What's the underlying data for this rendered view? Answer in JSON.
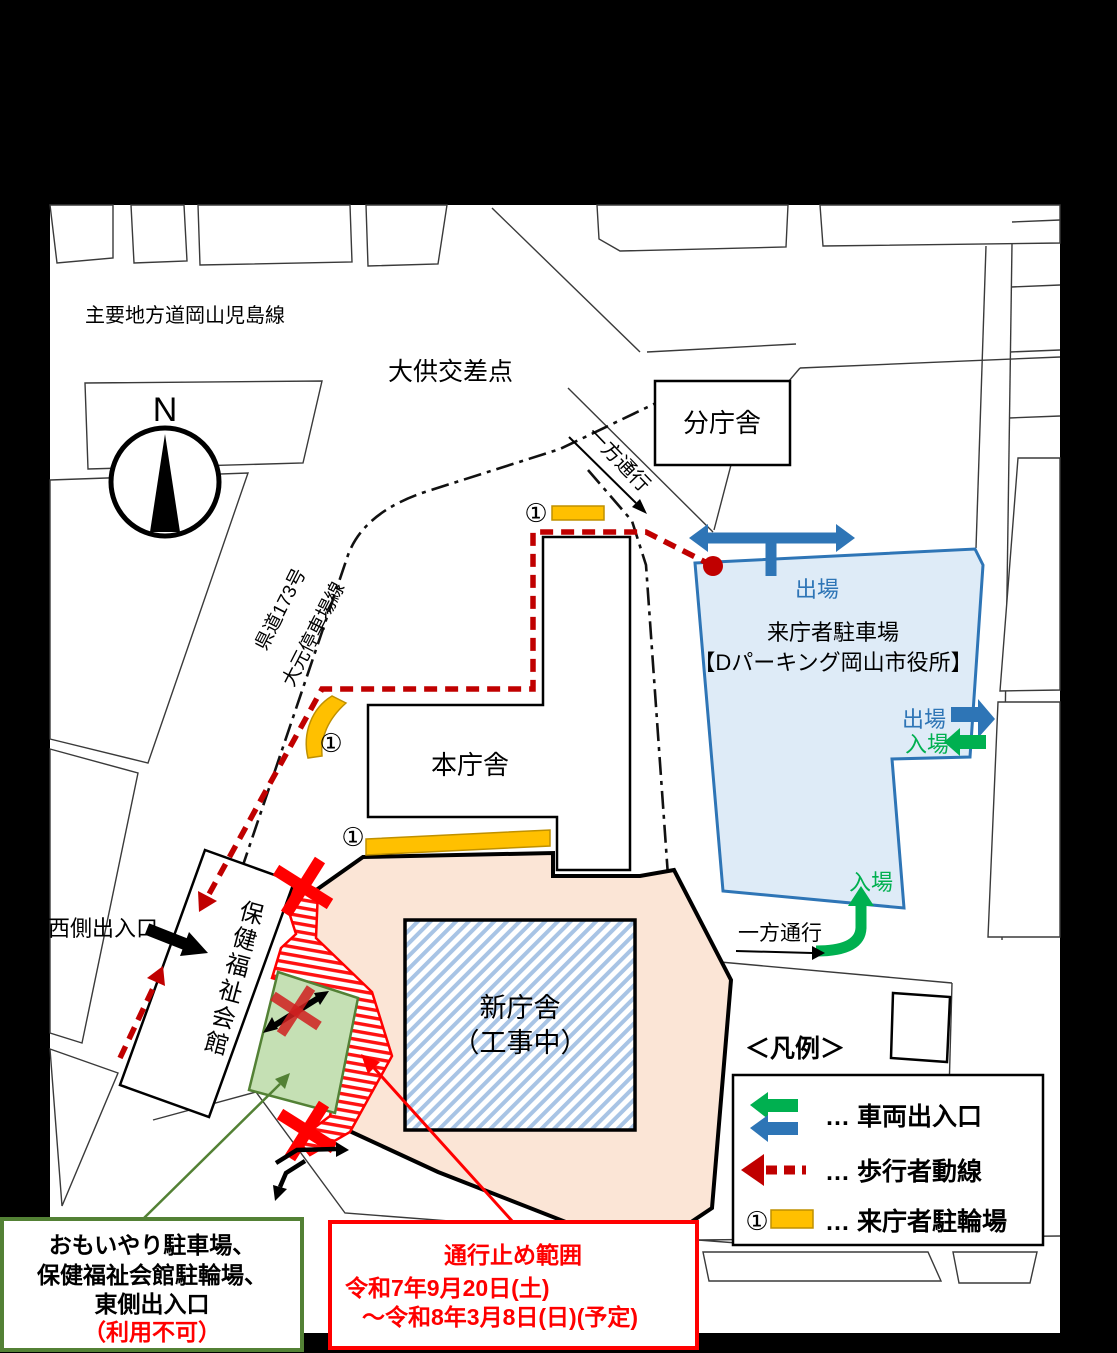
{
  "colors": {
    "background": "#000000",
    "map_bg": "#ffffff",
    "pedestrian_red": "#C00000",
    "bright_red": "#FF0000",
    "blue_arrow": "#2E75B6",
    "green_arrow": "#00B050",
    "green_border": "#538135",
    "parking_fill": "#DEEBF7",
    "construction_fill": "#FBE5D6",
    "hatch_blue": "#A8C4E5",
    "bike_yellow": "#FFC000",
    "bike_yellow_border": "#BF9000",
    "green_area_fill": "#C5E0B4"
  },
  "map": {
    "road_main_label": "主要地方道岡山児島線",
    "intersection_label": "大供交差点",
    "compass_label": "N",
    "pref_road_line1": "県道173号",
    "pref_road_line2": "大元停車場線",
    "one_way_top": "一方通行",
    "one_way_bottom": "一方通行",
    "branch_building": "分庁舎",
    "main_building": "本庁舎",
    "new_building_line1": "新庁舎",
    "new_building_line2": "（工事中）",
    "welfare_hall": "保健福祉会館",
    "west_entrance": "西側出入口",
    "bike_marker": "①",
    "parking_line1": "来庁者駐車場",
    "parking_line2": "【Dパーキング岡山市役所】",
    "exit_top": "出場",
    "exit_right": "出場",
    "enter_right": "入場",
    "enter_bottom": "入場"
  },
  "legend": {
    "title": "＜凡例＞",
    "vehicle_row_label": "… 車両出入口",
    "pedestrian_row_label": "… 歩行者動線",
    "bicycle_row_label": "… 来庁者駐輪場",
    "bicycle_marker": "①"
  },
  "callout_unavailable": {
    "line1": "おもいやり駐車場、",
    "line2": "保健福祉会館駐輪場、",
    "line3": "東側出入口",
    "line4": "（利用不可）"
  },
  "callout_closure": {
    "line1": "通行止め範囲",
    "line2": "令和7年9月20日(土)",
    "line3": "～令和8年3月8日(日)(予定)"
  }
}
